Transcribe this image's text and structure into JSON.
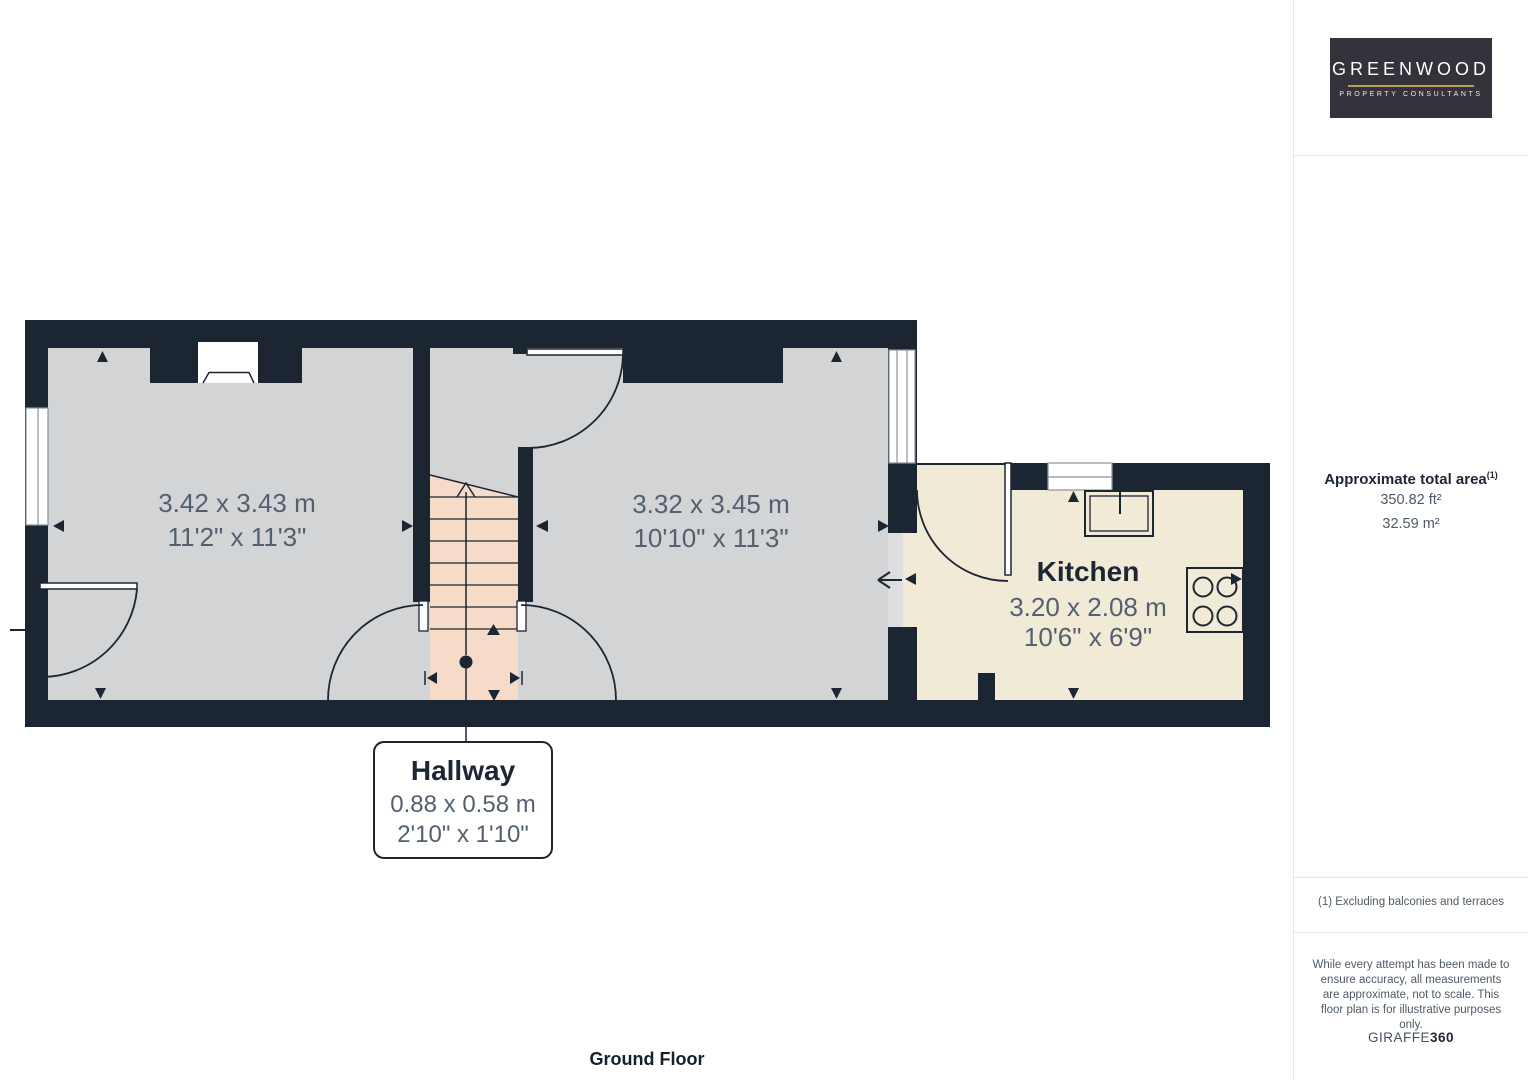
{
  "branding": {
    "logo_title": "GREENWOOD",
    "logo_subtitle": "PROPERTY CONSULTANTS"
  },
  "sidebar": {
    "area_title": "Approximate total area",
    "area_footnote_marker": "(1)",
    "area_imperial": "350.82 ft²",
    "area_metric": "32.59 m²",
    "footnote": "(1) Excluding balconies and terraces",
    "disclaimer": "While every attempt has been made to ensure accuracy, all measurements are approximate, not to scale. This floor plan is for illustrative purposes only.",
    "credit_brand": "GIRAFFE",
    "credit_suffix": "360"
  },
  "floorplan": {
    "floor_label": "Ground Floor",
    "rooms": {
      "room1": {
        "metric": "3.42 x 3.43 m",
        "imperial": "11'2\" x 11'3\""
      },
      "room2": {
        "metric": "3.32 x 3.45 m",
        "imperial": "10'10\" x 11'3\""
      },
      "kitchen": {
        "name": "Kitchen",
        "metric": "3.20 x 2.08 m",
        "imperial": "10'6\" x 6'9\""
      },
      "hallway": {
        "name": "Hallway",
        "metric": "0.88 x 0.58 m",
        "imperial": "2'10\" x 1'10\""
      }
    },
    "colors": {
      "wall": "#1c2633",
      "room_fill": "#d3d4d6",
      "kitchen_fill": "#f1ead6",
      "hallway_fill": "#f6dbc8",
      "dimension_text": "#53606f",
      "label_text": "#1c2634"
    }
  }
}
